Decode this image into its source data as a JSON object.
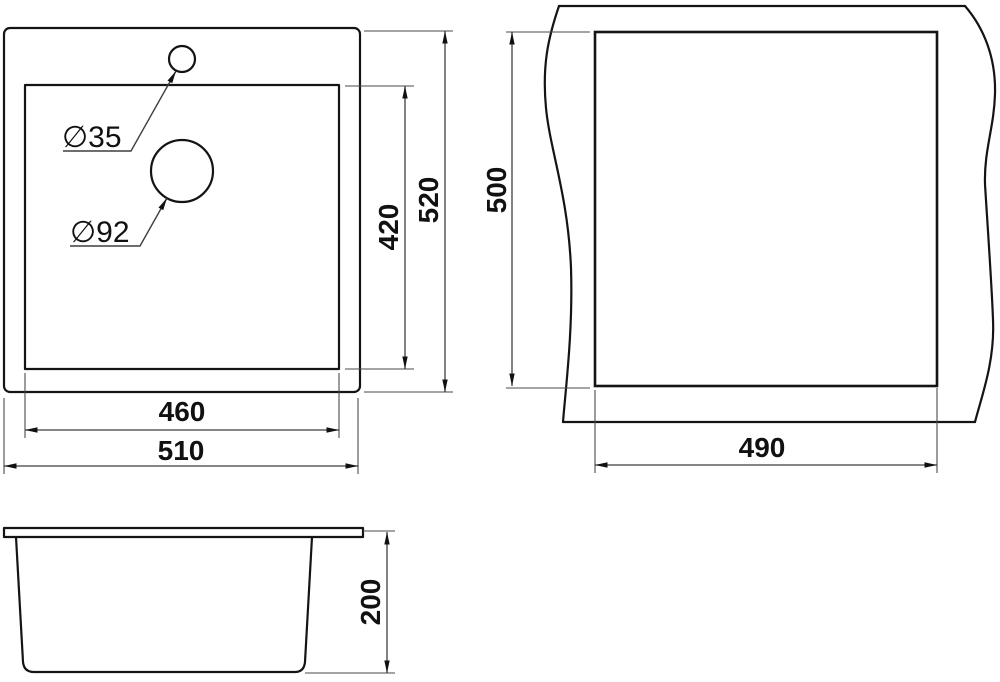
{
  "colors": {
    "background": "#ffffff",
    "object_line": "#141414",
    "dimension_line": "#3f3f3f",
    "text": "#111111"
  },
  "top_view": {
    "faucet_hole": "∅35",
    "drain_hole": "∅92",
    "inner_height": "420",
    "outer_height": "520",
    "inner_width": "460",
    "outer_width": "510"
  },
  "cutout_view": {
    "height": "500",
    "width": "490"
  },
  "side_view": {
    "height": "200"
  }
}
